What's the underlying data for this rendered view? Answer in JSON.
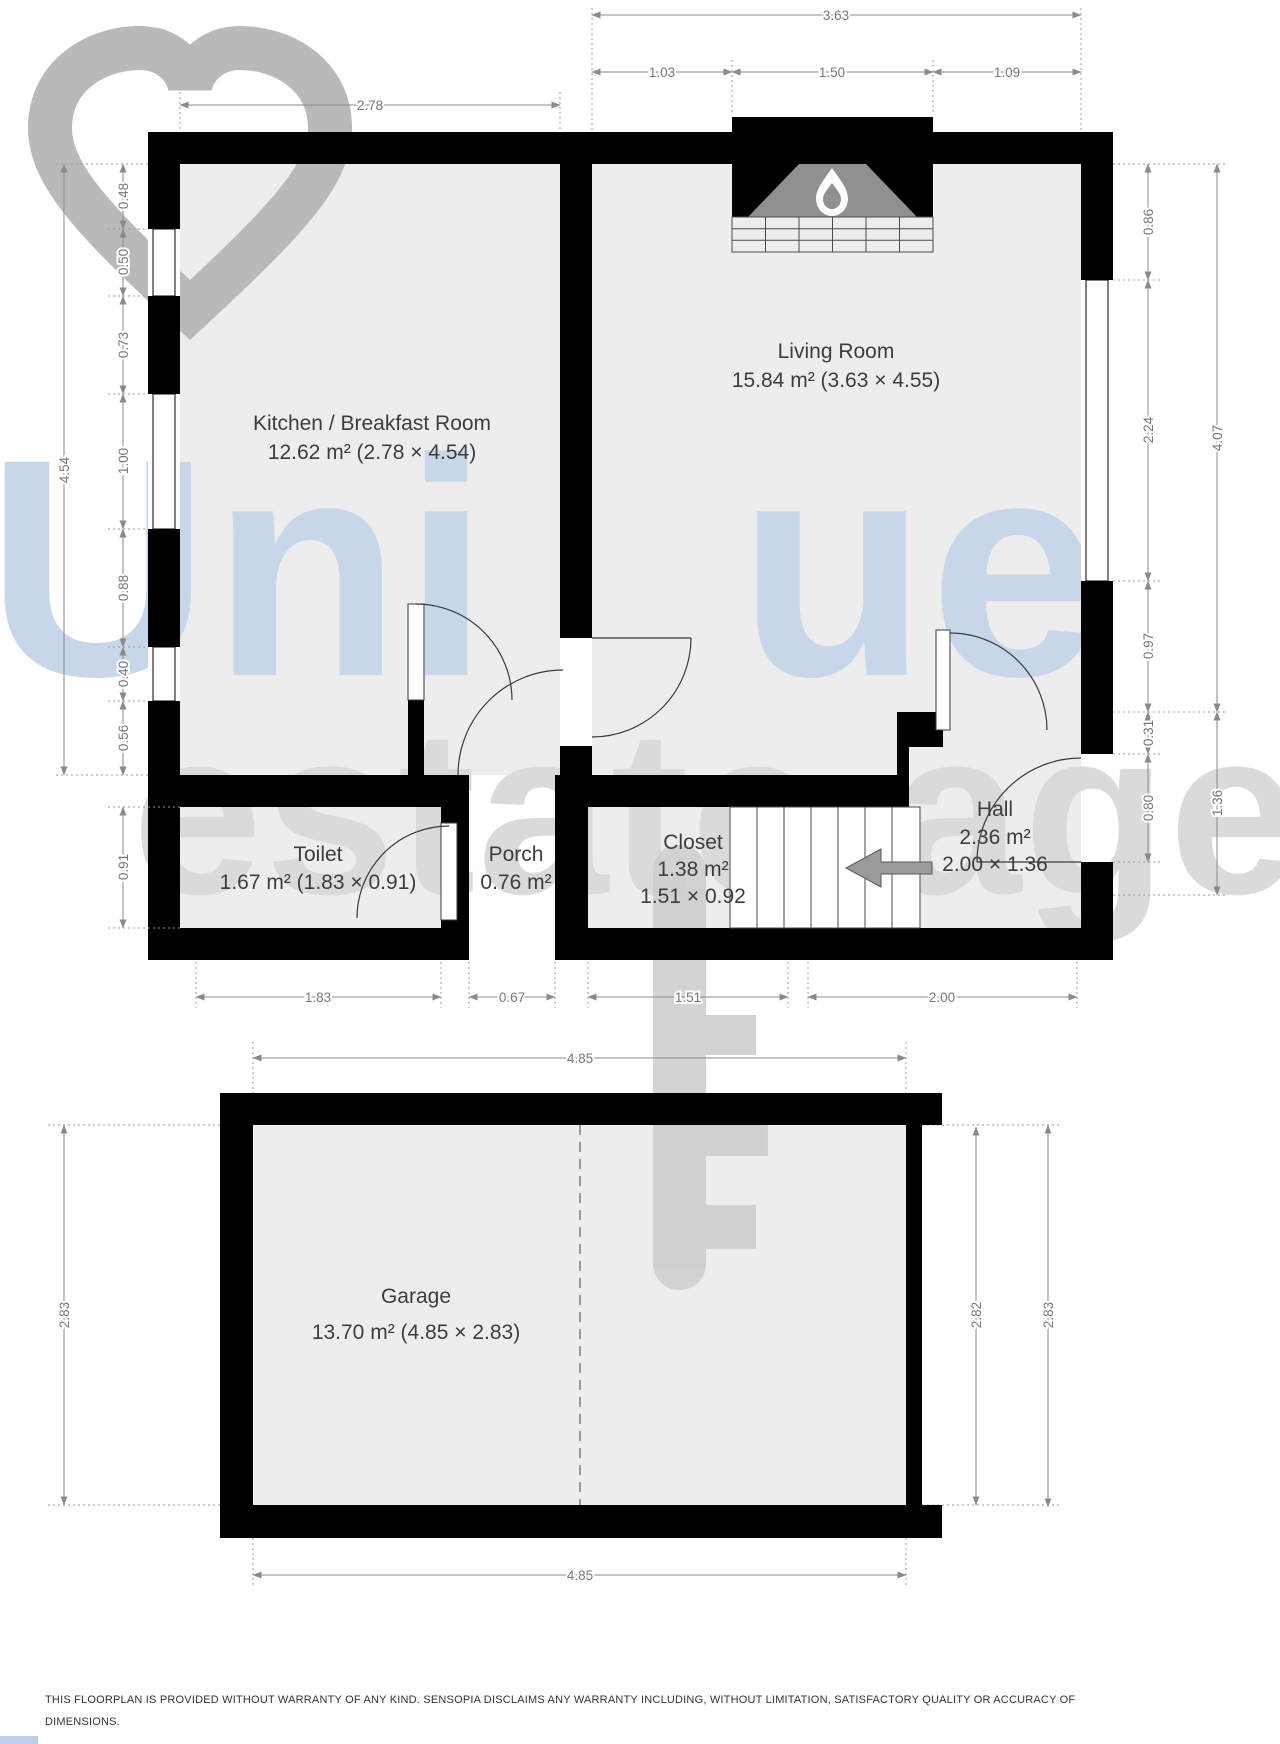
{
  "watermark": {
    "word1_prefix": "Uni",
    "word1_suffix": "ue",
    "word2": "estate agency"
  },
  "rooms": {
    "kitchen": {
      "name": "Kitchen / Breakfast Room",
      "detail": "12.62 m² (2.78 × 4.54)"
    },
    "living_room": {
      "name": "Living Room",
      "detail": "15.84 m² (3.63 × 4.55)"
    },
    "toilet": {
      "name": "Toilet",
      "detail": "1.67 m² (1.83 × 0.91)"
    },
    "porch": {
      "name": "Porch",
      "detail": "0.76 m²"
    },
    "closet": {
      "name": "Closet",
      "detail": "1.38 m²",
      "size": "1.51 × 0.92"
    },
    "hall": {
      "name": "Hall",
      "detail": "2.36 m²",
      "size": "2.00 × 1.36"
    },
    "garage": {
      "name": "Garage",
      "detail": "13.70 m² (4.85 × 2.83)"
    }
  },
  "dims": {
    "top_overall": "3.63",
    "top_seg": [
      "1.03",
      "1.50",
      "1.09"
    ],
    "kitchen_width": "2.78",
    "left_overall": "4.54",
    "left_seg": [
      "0.48",
      "0.50",
      "0.73",
      "1.00",
      "0.88",
      "0.40",
      "0.56"
    ],
    "toilet_h": "0.91",
    "right_seg": [
      "0.86",
      "2.24",
      "0.97",
      "0.31",
      "0.80"
    ],
    "right_overall": "4.07",
    "hall_h": "1.36",
    "bottom_seg": [
      "1.83",
      "0.67",
      "1.51",
      "2.00"
    ],
    "garage": {
      "top": "4.85",
      "bottom": "4.85",
      "left": "2.83",
      "inner_right": "2.82",
      "right": "2.83"
    }
  },
  "disclaimer": {
    "line1": "THIS FLOORPLAN IS PROVIDED WITHOUT WARRANTY OF ANY KIND. SENSOPIA DISCLAIMS ANY WARRANTY INCLUDING, WITHOUT LIMITATION, SATISFACTORY QUALITY OR ACCURACY OF",
    "line2": "DIMENSIONS."
  },
  "colors": {
    "wall": "#000000",
    "floor": "#ededed",
    "watermark_blue": "#c7d7e9",
    "watermark_gray": "#dadada",
    "heart_gray": "#b9b9b9",
    "key_gray": "#cccccc",
    "dimension_gray": "#8a8a8a",
    "fireplace_gray": "#909090"
  }
}
